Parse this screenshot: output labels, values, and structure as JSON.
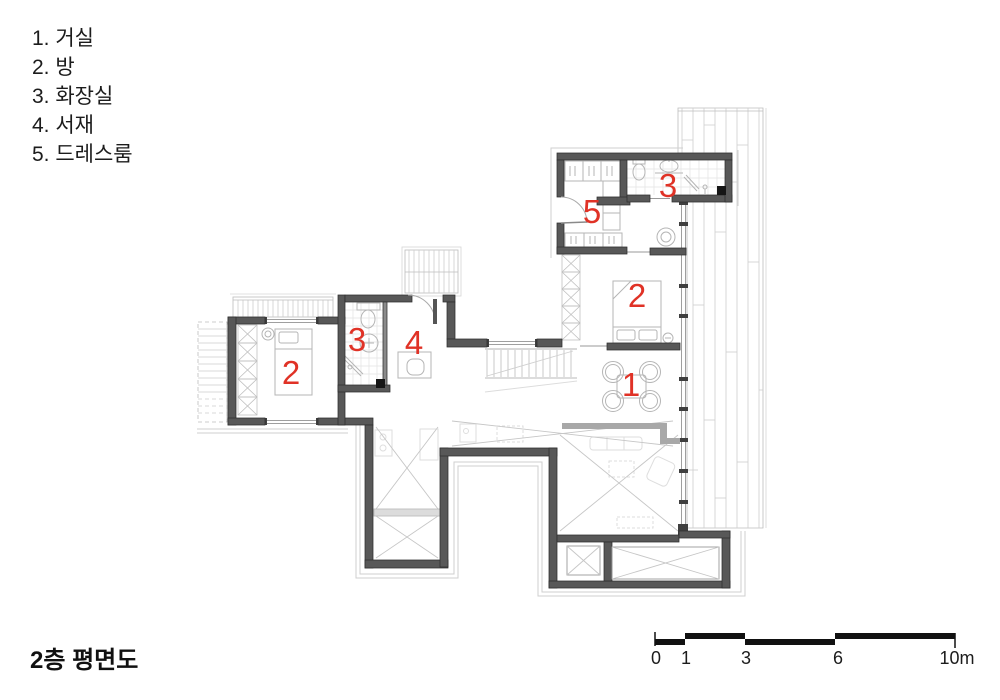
{
  "legend": {
    "items": [
      "1. 거실",
      "2. 방",
      "3. 화장실",
      "4. 서재",
      "5. 드레스룸"
    ]
  },
  "title": "2층 평면도",
  "scalebar": {
    "labels": [
      "0",
      "1",
      "3",
      "6",
      "10m"
    ]
  },
  "plan": {
    "room_labels": [
      {
        "value": "1"
      },
      {
        "value": "2"
      },
      {
        "value": "2"
      },
      {
        "value": "3"
      },
      {
        "value": "3"
      },
      {
        "value": "4"
      },
      {
        "value": "5"
      }
    ],
    "label_color": "#e03226"
  },
  "colors": {
    "wall": "#585858",
    "label_red": "#e03226",
    "light_line": "#c9c9c9"
  }
}
